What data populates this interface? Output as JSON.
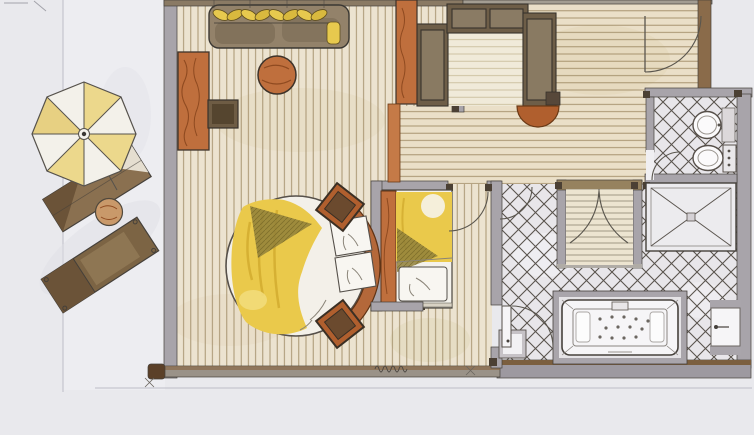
{
  "document": {
    "kind": "hand-drawn watercolor floor plan of a hotel suite",
    "visible_text": "none (only an illegible handwritten scribble near the lower wall)"
  },
  "palette": {
    "paper": "#e9e9ed",
    "terrace_paper": "#ededf1",
    "bedroom_floor": "#ece3d0",
    "hall_floor": "#eadfc8",
    "closet_floor": "#f0ead9",
    "tile_floor": "#e8e6ea",
    "sauna_floor": "#ece4d0",
    "shower_floor": "#ecebee",
    "wall_grey": "#a8a4aa",
    "wall_brown": "#8a6b4a",
    "wood_orange": "#bf6f3d",
    "wood_dark": "#6e5e48",
    "cushion_yellow": "#e7c94e",
    "blanket_yellow": "#eac94b",
    "shadow_olive": "#90803a",
    "fixture_white": "#f6f5f7",
    "ink": "#45403b"
  },
  "plan": {
    "terrace": {
      "items": [
        "parasol",
        "sun-lounger",
        "side-table",
        "sun-lounger"
      ]
    },
    "bedroom": {
      "items": [
        "sofa-daybed with yellow bolster cushions",
        "round coffee-table",
        "sideboard",
        "tv-unit",
        "round bed with curved headboard",
        "nightstand",
        "nightstand",
        "wardrobe"
      ]
    },
    "dressing_room": {
      "items": [
        "closet-left-unit",
        "closet-back-unit",
        "closet-right-unit",
        "half-round-bench"
      ]
    },
    "entry_hall": {
      "items": [
        "entry-door"
      ]
    },
    "second_bedroom": {
      "items": [
        "single-bed",
        "pillow",
        "headboard-panel"
      ]
    },
    "wc": {
      "items": [
        "washbasin",
        "toilet"
      ]
    },
    "bathroom": {
      "items": [
        "sauna with double doors",
        "walk-in shower",
        "whirlpool-bathtub",
        "bathroom-door",
        "storage-niche"
      ]
    },
    "annotation": {
      "items": [
        "handwritten-scribble"
      ]
    }
  }
}
